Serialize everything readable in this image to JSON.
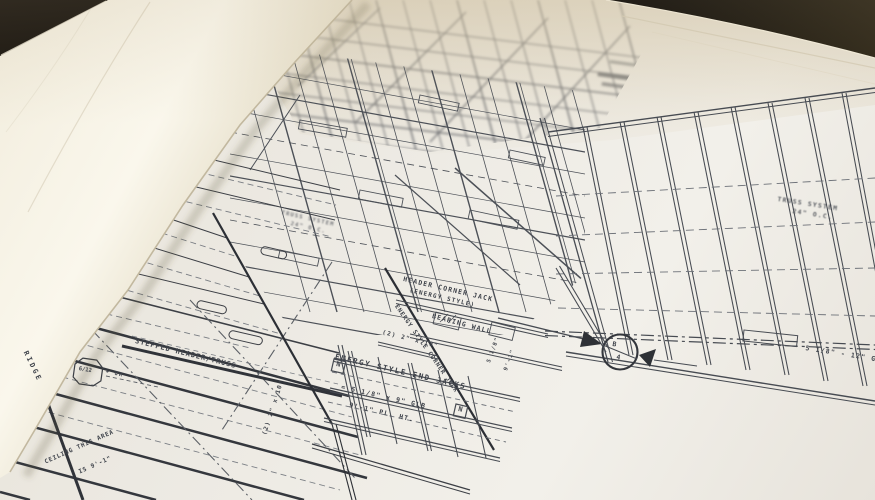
{
  "scene": {
    "description": "Photograph of rolled-open architectural framing blueprints",
    "colors": {
      "paper": "#efece6",
      "curl_paper": "#f6f1e2",
      "ink": "#3c3f45",
      "background_dark": "#14100b"
    }
  },
  "labels": {
    "header_corner_jack": "HEADER CORNER JACK",
    "header_corner_jack_sub": "(ENERGY STYLE)",
    "bearing_wall": "BEARING WALL",
    "energy_corner_jack": "ENERGY STYLE CORNER JACK",
    "end_jacks": "ENERGY STYLE END JACKS",
    "glb_spec": "= 5 1/8\" x 9\" GLB",
    "plate_height": "9'-1\" PL. HT.",
    "double_2x10": "(2) 2\" x 10\"",
    "double_2x10_side": "(2) 2\" x 10\"",
    "stepped_header": "STEPPED HEADER/TRUSS",
    "ridge": "RIDGE",
    "ceiling_note_1": "CEILING THIS AREA",
    "ceiling_note_2": "IS 9'-1\"",
    "pitch_value": "6/12",
    "pitch_tolerance": "+ OR -",
    "truss_system_right_1": "TRUSS SYSTEM",
    "truss_system_right_2": "24\" O.C.",
    "truss_system_left_1": "TRUSS SYSTEM",
    "truss_system_left_2": "24\" O.C.",
    "glb_beam_right": "5 1/8\" - 12\" GLB",
    "section_marker_letter": "B",
    "section_marker_sheet": "4",
    "dim_5_1_8": "5 1/8\"",
    "dim_9_1": "9'-1\"",
    "holddown_symbol": "N"
  }
}
